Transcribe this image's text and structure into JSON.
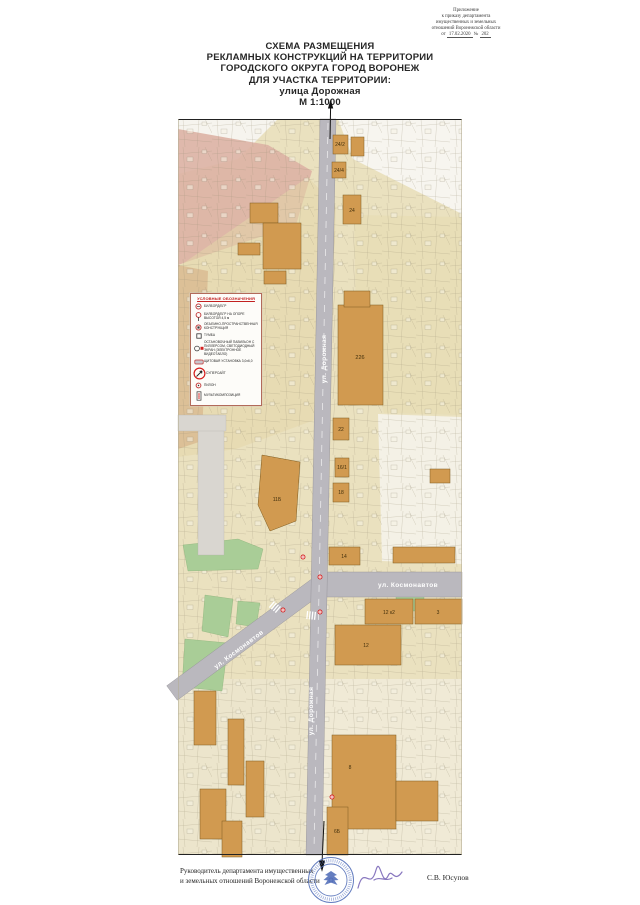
{
  "appendix": {
    "lines": [
      "Приложение",
      "к приказу департамента",
      "имущественных и земельных",
      "отношений Воронежской области"
    ],
    "date_prefix": "от",
    "date": "17.02.2020",
    "num_label": "№",
    "number": "202"
  },
  "title": {
    "lines": [
      "СХЕМА РАЗМЕЩЕНИЯ",
      "РЕКЛАМНЫХ КОНСТРУКЦИЙ НА ТЕРРИТОРИИ",
      "ГОРОДСКОГО ОКРУГА ГОРОД ВОРОНЕЖ",
      "ДЛЯ УЧАСТКА ТЕРРИТОРИИ:",
      "улица Дорожная",
      "М 1:1000"
    ]
  },
  "legend": {
    "title": "УСЛОВНЫЕ ОБОЗНАЧЕНИЯ",
    "items": [
      {
        "icon": "billboard-icon",
        "label": "БИЛБОРД/БГР"
      },
      {
        "icon": "billboard-pole-icon",
        "label": "БИЛБОРД/БГР НА ОПОРЕ ВЫСОТОЙ 4,5 м"
      },
      {
        "icon": "volumetric-structure-icon",
        "label": "ОБЪЕМНО-ПРОСТРАНСТВЕННАЯ КОНСТРУКЦИЯ"
      },
      {
        "icon": "tumba-icon",
        "label": "ТУМБА"
      },
      {
        "icon": "pavilion-icon",
        "label": "ОСТАНОВОЧНЫЙ ПАВИЛЬОН С ПИЛЛЕРСОМ, СВЕТОДИОДНЫЙ ЭКРАН (ЭЛЕКТРОННОЕ ВИДЕОТАБЛО)"
      },
      {
        "icon": "shield-board-icon",
        "label": "ЩИТОВАЯ УСТАНОВКА 3,0х6,0"
      },
      {
        "icon": "supersite-icon",
        "label": "СУПЕРСАЙТ"
      },
      {
        "icon": "pylon-icon",
        "label": "ПИЛОН"
      },
      {
        "icon": "multicomposition-icon",
        "label": "МУЛЬТИКОМПОЗИЦИЯ"
      }
    ]
  },
  "map": {
    "streets": {
      "dorozhnaya": "ул. Дорожная",
      "kosmonavtov": "ул. Космонавтов"
    },
    "buildings": {
      "b24_2": "24/2",
      "b24_4": "24/4",
      "b24": "24",
      "b226": "226",
      "b22": "22",
      "b16_1": "16/1",
      "b18": "18",
      "b11b": "11Б",
      "b14": "14",
      "b12k2": "12 к2",
      "b3": "3",
      "b12": "12",
      "b8": "8",
      "b6b": "6Б"
    }
  },
  "footer": {
    "signer_title_line1": "Руководитель департамента имущественных",
    "signer_title_line2": "и земельных отношений Воронежской области",
    "signer_name": "С.В. Юсупов"
  },
  "colors": {
    "map_base": "#eae1bf",
    "building_fill": "#d19a50",
    "road_fill": "#bab8be",
    "green_fill": "#a9cd97",
    "pink_zone": "#ddb2a4",
    "marker_red": "#d42020",
    "stamp_blue": "#4a67b5",
    "legend_title_red": "#c22020"
  }
}
